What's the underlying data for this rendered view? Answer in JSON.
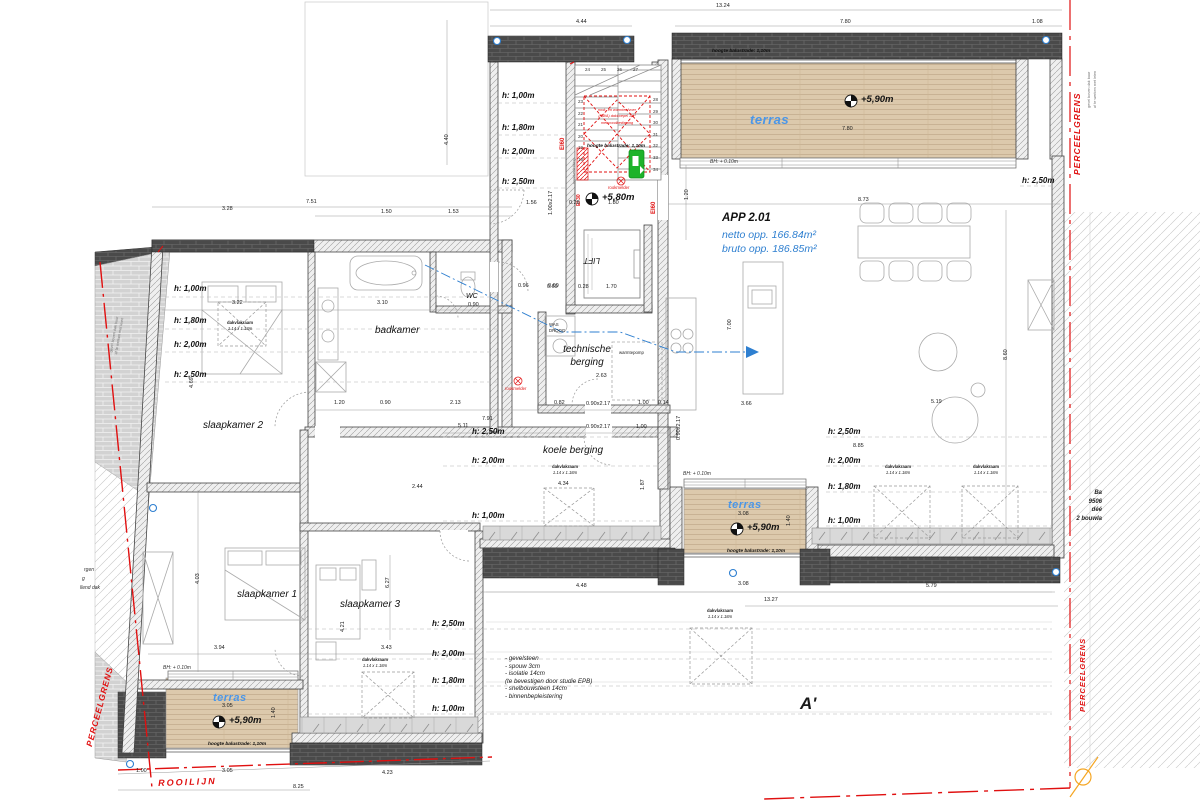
{
  "plan": {
    "app": {
      "title": "APP 2.01",
      "netto": "netto opp. 166.84m²",
      "bruto": "bruto opp. 186.85m²"
    },
    "rooms": {
      "slaapkamer1": "slaapkamer 1",
      "slaapkamer2": "slaapkamer 2",
      "slaapkamer3": "slaapkamer 3",
      "badkamer": "badkamer",
      "wc": "WC",
      "wc_w": "0.90",
      "technische1": "technische",
      "technische2": "berging",
      "koele": "koele berging",
      "lift": "LIFT",
      "warmtepomp": "warmtepomp",
      "was": "WAS",
      "droog": "DROOG",
      "terras": "terras"
    },
    "heights": {
      "h100": "h: 1,00m",
      "h180": "h: 1,80m",
      "h200": "h: 2,00m",
      "h250": "h: 2,50m"
    },
    "levels": {
      "terras": "+5,90m",
      "hal": "+5,80m"
    },
    "balustrade": "hoogte balustrade: 1,10m",
    "bh": "BH: + 0.10m",
    "window": {
      "name": "dakvlakraam",
      "size": "1.14 x 1.18m"
    },
    "fire": {
      "ei60": "EI60",
      "ei30": "EI 30",
      "rookmelder": "rookmelder",
      "nood": "noodverlichting",
      "rwa": [
        "rook- en warmteafvoer",
        "(RWA) dakkoepel 1m²",
        "met noodbediening"
      ]
    },
    "stairs": {
      "left": [
        "23",
        "22",
        "21",
        "20",
        "19",
        "18"
      ],
      "right": [
        "28",
        "29",
        "30",
        "31",
        "32",
        "33",
        "34"
      ],
      "top": [
        "24",
        "25",
        "26",
        "27"
      ]
    },
    "notes": [
      "- gevelsteen",
      "- spouw 3cm",
      "- isolatie 14cm",
      "(te bevestigen door studie EPB)",
      "- snelbouwsteen 14cm",
      "- binnenbepleistering"
    ],
    "boundary": {
      "perceelgrens": "PERCEELGRENS",
      "rooilijn": "ROOILIJN",
      "note1": "gevel boven dak buur",
      "note2": "af te werken met leien",
      "frag": [
        "rgen",
        "g",
        "llend dak"
      ],
      "right_note": [
        "Ba",
        "9506",
        "déé",
        "2 bouwla"
      ]
    },
    "section": "A'",
    "dims": {
      "top_total": "13.24",
      "top_a": "4.44",
      "top_b": "7.80",
      "top_c": "1.08",
      "lw_total": "7.51",
      "lw_a": "3.28",
      "lw_b": "1.50",
      "lw_c": "1.53",
      "right_total": "8.73",
      "terras1_w": "7.80",
      "bad_a": "3.22",
      "bad_b": "3.10",
      "wc_a": "0.96",
      "wc_b": "0.60",
      "r1a": "1.20",
      "r1b": "0.90",
      "r1c": "2.13",
      "r1d": "0.82",
      "r1e": "0.90x2.17",
      "r1f": "1.00",
      "r1g": "0.14",
      "r2a": "5.11",
      "r2t": "7.91",
      "r2b": "0.90x2.17",
      "r2c": "1.00",
      "koele_a": "4.34",
      "koele_b": "2.44",
      "s1_w": "3.94",
      "s3_w": "3.43",
      "bot_a": "3.05",
      "bot_b": "4.23",
      "bot_c": "8.25",
      "bot_d": "1.00",
      "t3_w": "3.05",
      "t2_w": "3.08",
      "bot_mid": "4.48",
      "bot_total": "13.27",
      "bot_right": "5.79",
      "liv_a": "8.85",
      "liv_b": "5.19",
      "liv_c": "3.66",
      "tech_w": "2.63",
      "lift_a": "0.60",
      "lift_b": "0.28",
      "lift_w": "1.70",
      "hall_a": "1.56",
      "hall_b": "0.28",
      "hall_c": "1.80",
      "v440": "4.40",
      "v120": "1.20",
      "v700": "7.00",
      "v860": "8.60",
      "v187": "1.87",
      "v140": "1.40",
      "v403": "4.03",
      "v421": "4.21",
      "v627": "6.27",
      "v469": "4.69",
      "v100217": "1.00x2.17",
      "v90217": "0.90x2.17"
    }
  }
}
